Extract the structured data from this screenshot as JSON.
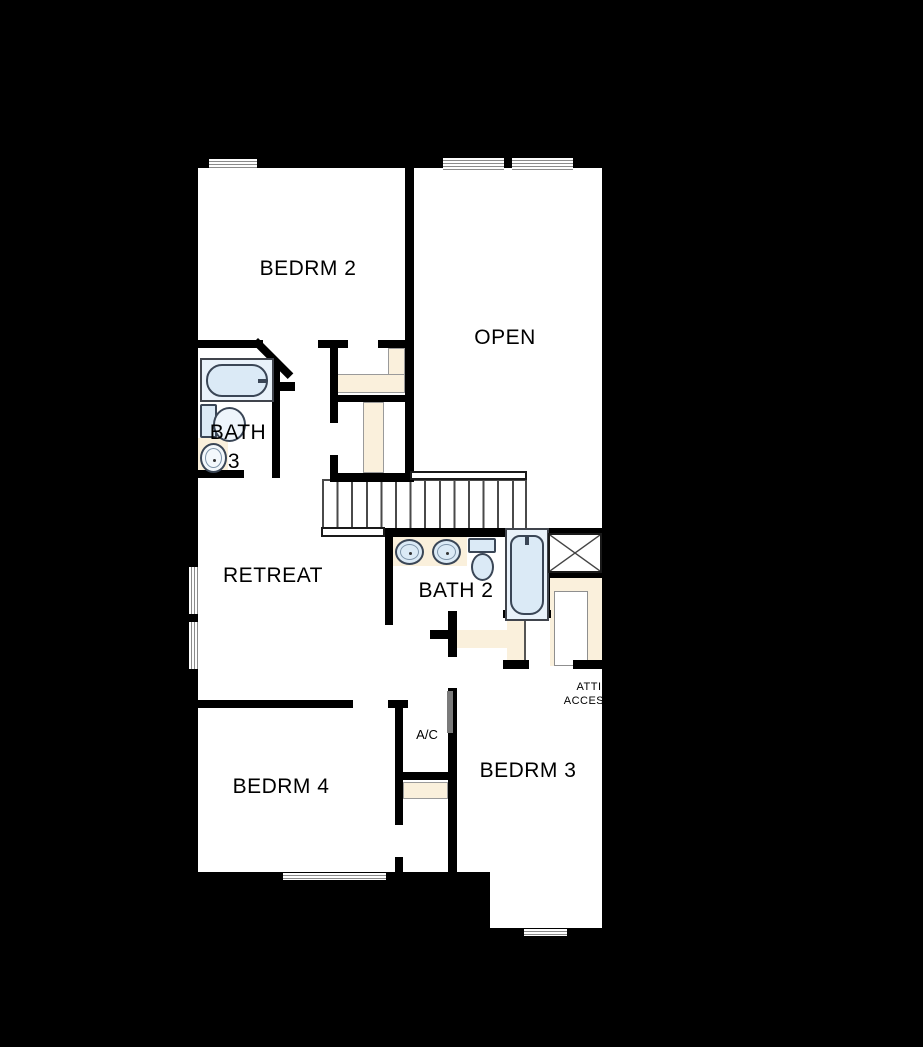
{
  "plan": {
    "name": "Second Floor Plan",
    "colors": {
      "background": "#000000",
      "floor": "#ffffff",
      "wall": "#000000",
      "closet_fill": "#faf0dc",
      "fixture_fill": "#dbeaf6",
      "fixture_stroke": "#3a4656",
      "stair_line": "#4a4a4a",
      "window_line": "#8a8a8a",
      "door_leaf": "#7a7a7a",
      "label_text": "#000000"
    },
    "rooms": {
      "bedrm2": {
        "label": "BEDRM 2"
      },
      "open": {
        "label": "OPEN"
      },
      "bath3": {
        "line1": "BATH",
        "line2": "3"
      },
      "retreat": {
        "label": "RETREAT"
      },
      "bath2": {
        "label": "BATH 2"
      },
      "bedrm4": {
        "label": "BEDRM 4"
      },
      "bedrm3": {
        "label": "BEDRM 3"
      },
      "ac": {
        "label": "A/C"
      },
      "attic": {
        "line1": "ATTIC",
        "line2": "ACCESS"
      }
    }
  }
}
